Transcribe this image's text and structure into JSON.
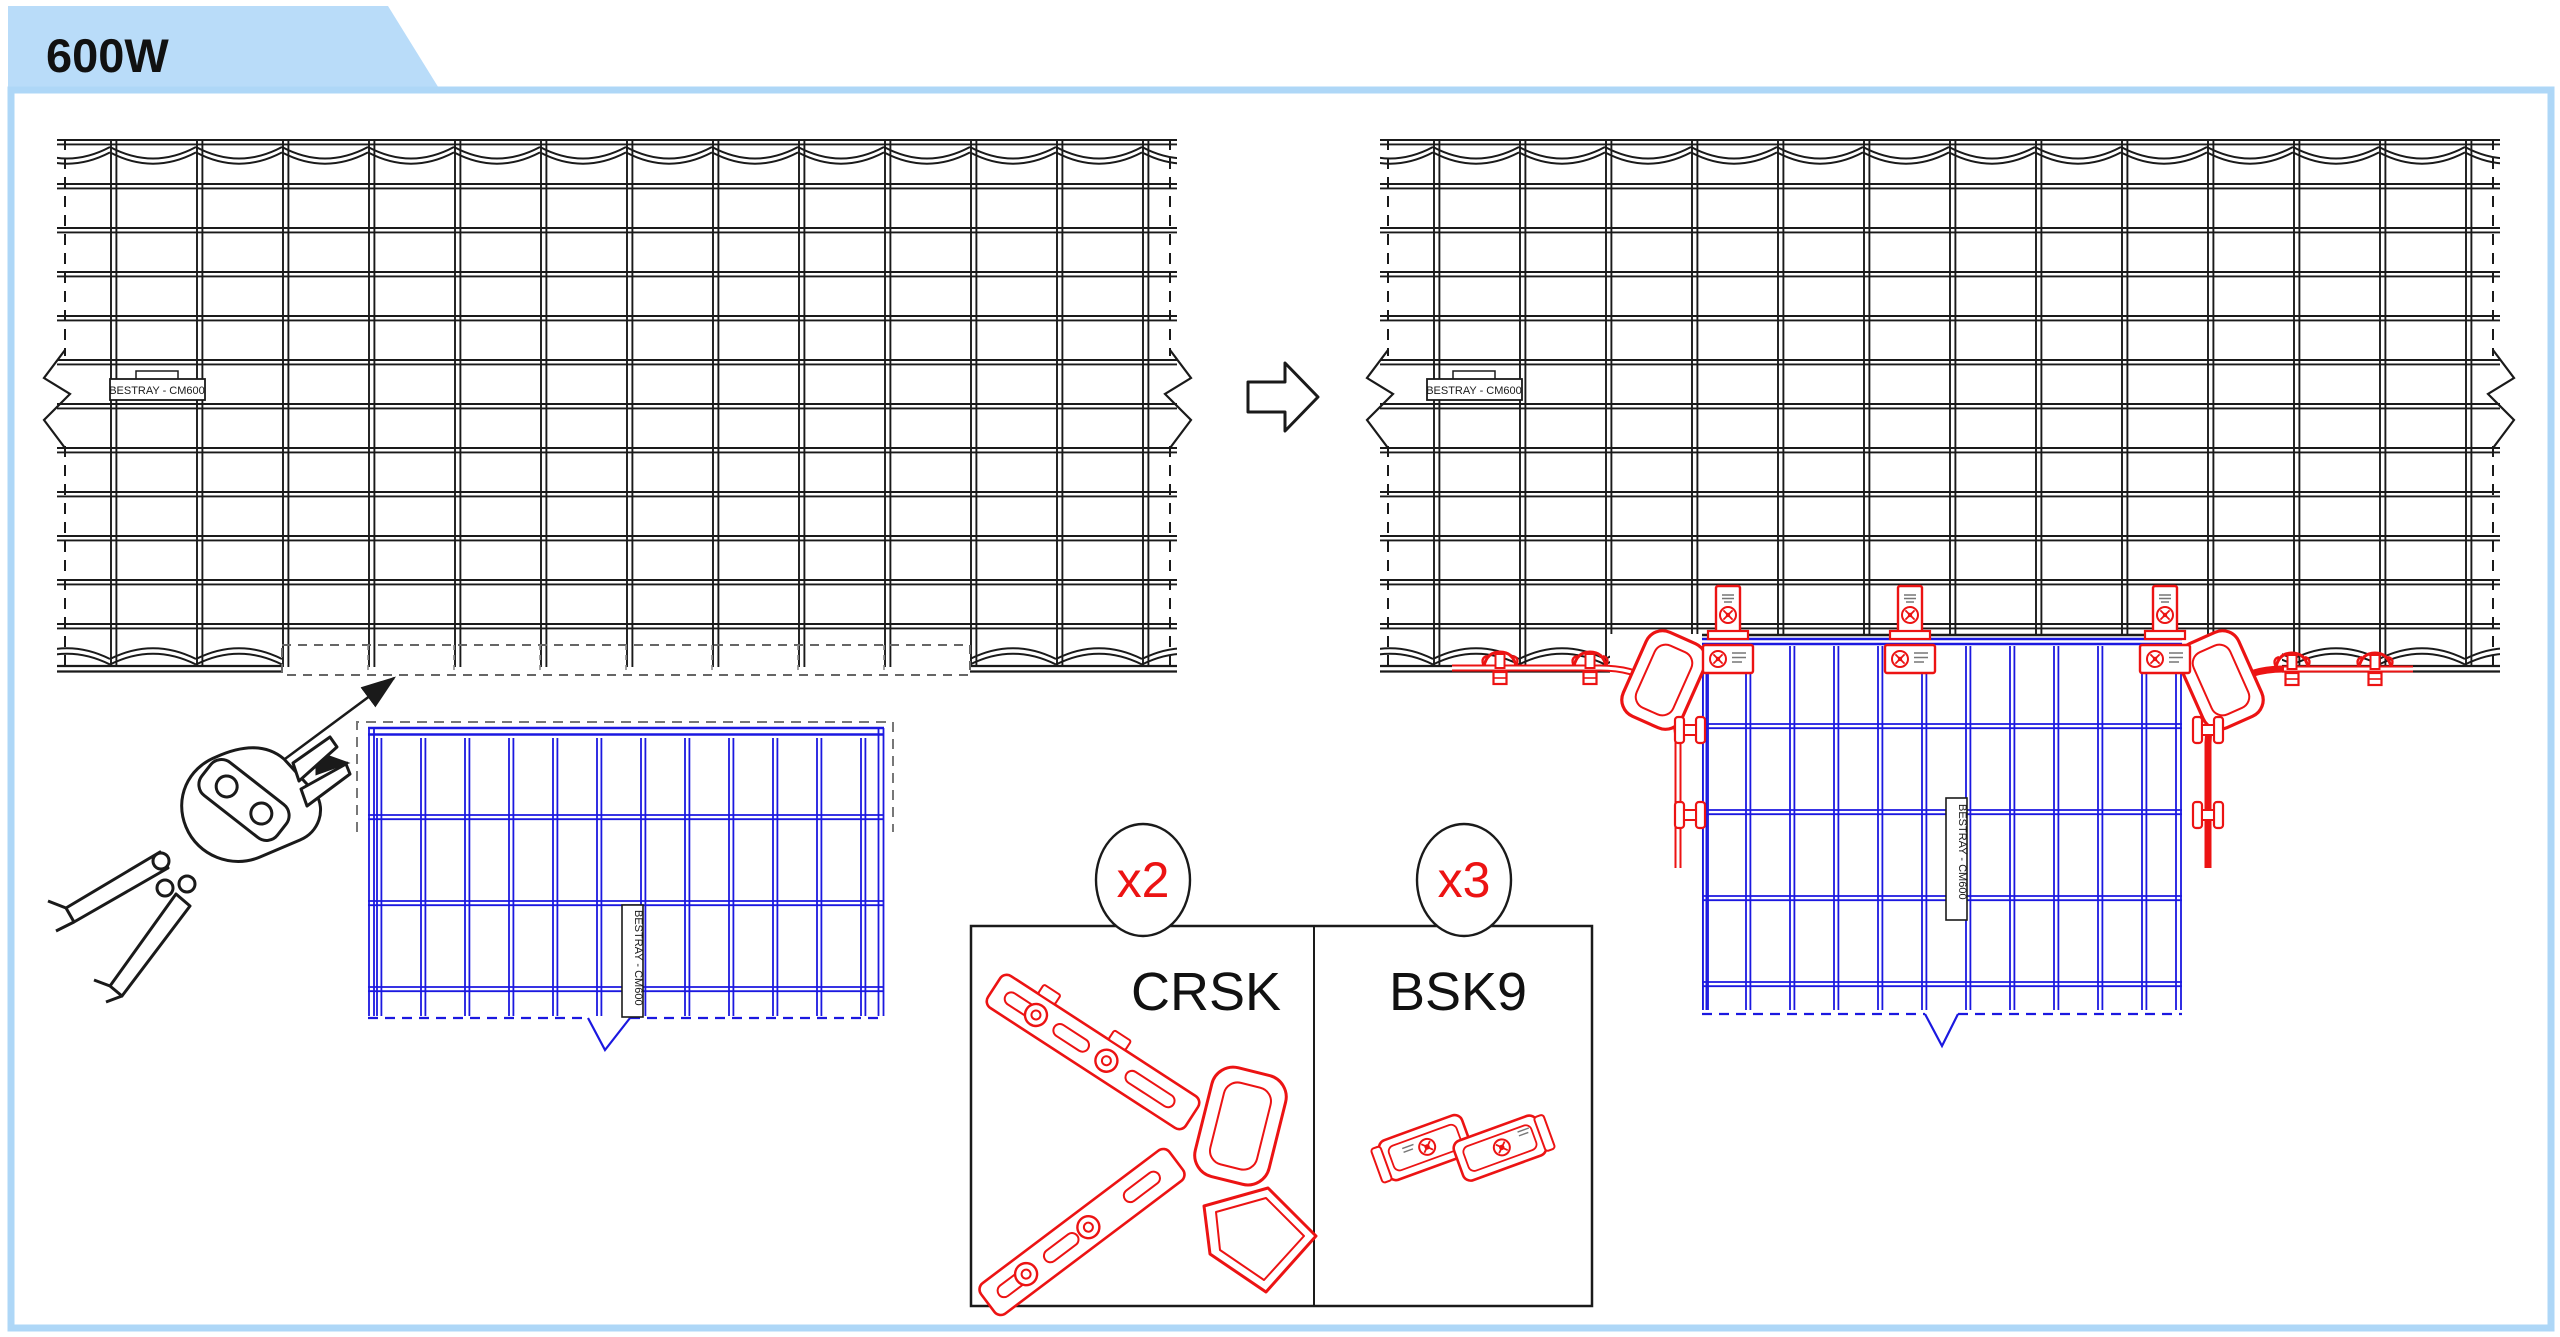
{
  "page": {
    "tab_label": "600W"
  },
  "colors": {
    "tab_bg": "#b9dcf9",
    "frame_border": "#aed7f7",
    "drawing_line": "#1a1a1a",
    "cut_piece_blue": "#1b18e0",
    "hardware_red": "#ec1313",
    "dashed_gray": "#6f6f6f"
  },
  "source_tray": {
    "name_label": "BESTRAY - CM600"
  },
  "cut_piece": {
    "name_label": "BESTRAY - CM600"
  },
  "result_tray": {
    "name_label": "BESTRAY - CM600",
    "drop_label": "BESTRAY - CM600"
  },
  "parts": {
    "items": [
      {
        "qty": "x2",
        "code": "CRSK"
      },
      {
        "qty": "x3",
        "code": "BSK9"
      }
    ]
  }
}
